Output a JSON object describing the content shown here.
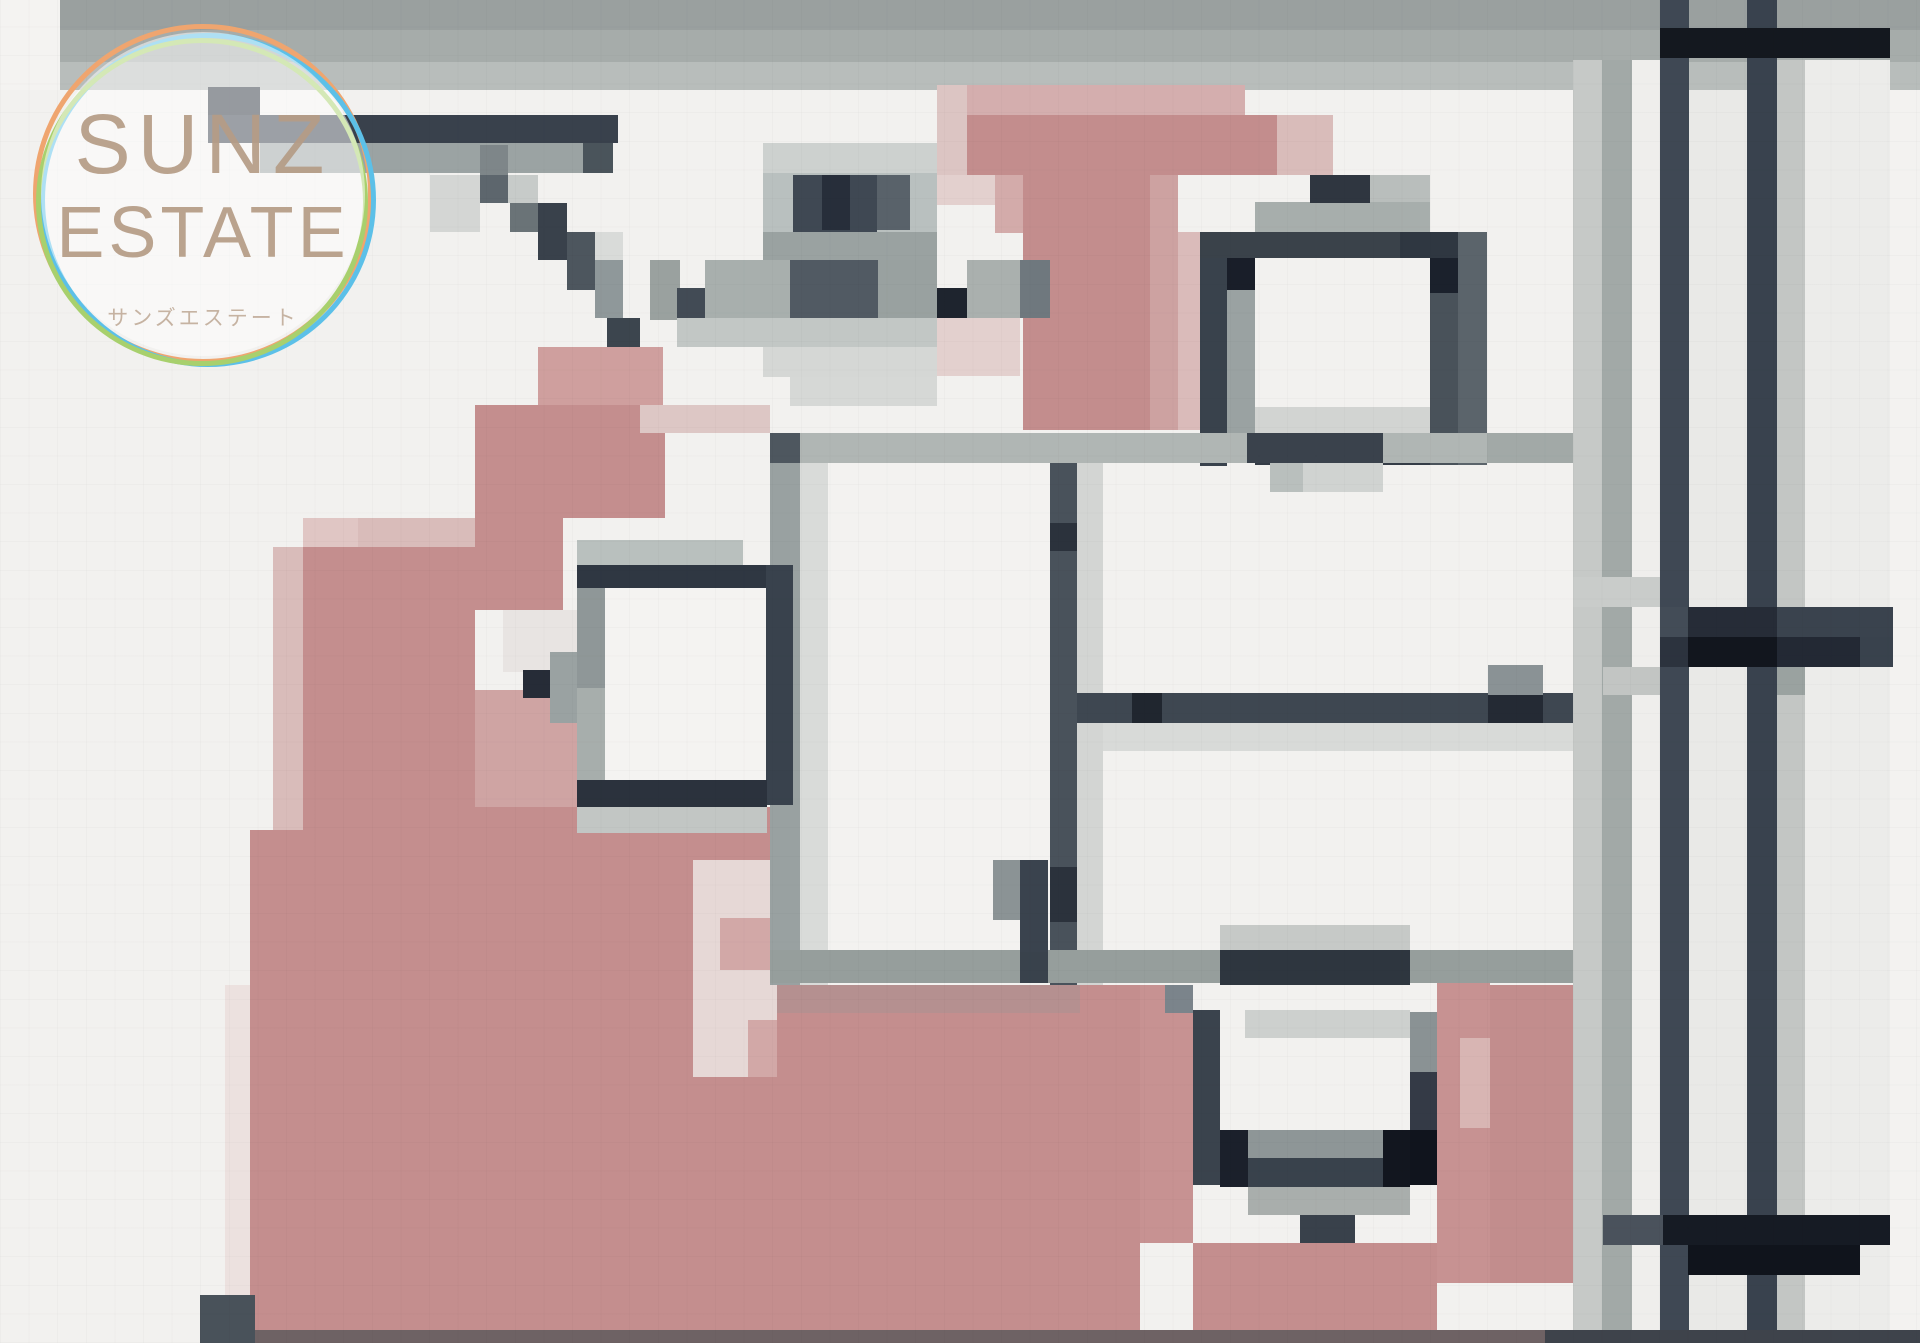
{
  "meta": {
    "description": "Pixelated (mosaic-censored) real-estate floor plan photo with agency watermark",
    "width": 1920,
    "height": 1343,
    "background": "#f2f1ef"
  },
  "logo": {
    "line1": "SUNZ",
    "line2": "ESTATE",
    "line3": "サンズエステート",
    "text_color": "#b59c86",
    "ring_colors": [
      "#efa56f",
      "#5cc0e8",
      "#a8d06d"
    ],
    "fill": "rgba(255,255,255,0.5)"
  },
  "palette_notes": {
    "wall_dark": "#39424c",
    "wall_black": "#12161e",
    "floor_pink": "#c48e8e",
    "floor_pink_light": "#d9bcba",
    "gray_wall": "#9ba3a3",
    "top_band": "#a6acaa",
    "background": "#f2f1ef"
  },
  "blocks": [
    [
      "#9aa09f",
      0,
      0,
      1920,
      30
    ],
    [
      "#a6acaa",
      0,
      30,
      1920,
      32
    ],
    [
      "#b8bdbb",
      0,
      62,
      1920,
      28
    ],
    [
      "#f4f3f1",
      0,
      0,
      60,
      90
    ],
    [
      "#c6c9c7",
      1573,
      60,
      29,
      1283
    ],
    [
      "#a2a9a7",
      1602,
      60,
      30,
      1283
    ],
    [
      "#efeeec",
      1632,
      60,
      28,
      1283
    ],
    [
      "#e9e9e7",
      1689,
      90,
      58,
      1253
    ],
    [
      "#c3c6c4",
      1777,
      60,
      28,
      1283
    ],
    [
      "#ececea",
      1805,
      60,
      85,
      1283
    ],
    [
      "#f3f2f0",
      1890,
      90,
      30,
      1253
    ],
    [
      "#3f4854",
      1660,
      0,
      29,
      1343
    ],
    [
      "#39424e",
      1747,
      0,
      30,
      1343
    ],
    [
      "#14181f",
      1660,
      28,
      230,
      30
    ],
    [
      "#2d343f",
      208,
      87,
      52,
      28
    ],
    [
      "#39414c",
      208,
      115,
      410,
      28
    ],
    [
      "#9ba3a3",
      260,
      143,
      323,
      30
    ],
    [
      "#4a545b",
      583,
      143,
      30,
      30
    ],
    [
      "#d4d6d4",
      430,
      175,
      50,
      57
    ],
    [
      "#7e8689",
      480,
      145,
      28,
      30
    ],
    [
      "#5d666d",
      480,
      175,
      30,
      28
    ],
    [
      "#c7cbc9",
      508,
      175,
      30,
      28
    ],
    [
      "#6a7377",
      510,
      203,
      28,
      29
    ],
    [
      "#39414b",
      538,
      203,
      29,
      57
    ],
    [
      "#d9dbd9",
      595,
      232,
      28,
      28
    ],
    [
      "#4d565e",
      567,
      232,
      28,
      58
    ],
    [
      "#8f989a",
      595,
      260,
      28,
      58
    ],
    [
      "#3c454e",
      607,
      318,
      33,
      29
    ],
    [
      "#cf9f9e",
      538,
      347,
      125,
      58
    ],
    [
      "#c48e8e",
      475,
      405,
      190,
      113
    ],
    [
      "#ddc7c5",
      640,
      405,
      130,
      28
    ],
    [
      "#e0c6c4",
      303,
      518,
      57,
      29
    ],
    [
      "#d9bcba",
      358,
      518,
      117,
      29
    ],
    [
      "#c48e8e",
      475,
      518,
      88,
      92
    ],
    [
      "#e8e4e2",
      503,
      610,
      74,
      62
    ],
    [
      "#cfa4a3",
      475,
      690,
      102,
      117
    ],
    [
      "#d9bcba",
      273,
      547,
      30,
      283
    ],
    [
      "#c48e8e",
      303,
      547,
      172,
      438
    ],
    [
      "#c48e8e",
      250,
      830,
      225,
      155
    ],
    [
      "#c48e8e",
      475,
      807,
      295,
      178
    ],
    [
      "#dcc5c3",
      937,
      85,
      30,
      90
    ],
    [
      "#d4aeae",
      967,
      85,
      278,
      30
    ],
    [
      "#c38d8d",
      967,
      115,
      310,
      60
    ],
    [
      "#d9bcba",
      1277,
      115,
      56,
      60
    ],
    [
      "#e3d0ce",
      937,
      175,
      58,
      30
    ],
    [
      "#d3abaa",
      995,
      175,
      30,
      58
    ],
    [
      "#c38d8d",
      1023,
      175,
      127,
      255
    ],
    [
      "#cda2a1",
      1150,
      175,
      28,
      255
    ],
    [
      "#dabbba",
      1178,
      232,
      32,
      198
    ],
    [
      "#e3d0ce",
      937,
      318,
      83,
      58
    ],
    [
      "#ece1df",
      225,
      985,
      25,
      345
    ],
    [
      "#c48e8e",
      250,
      985,
      890,
      345
    ],
    [
      "#e6d8d6",
      693,
      860,
      84,
      217
    ],
    [
      "#d2a8a7",
      720,
      918,
      57,
      52
    ],
    [
      "#d2a8a7",
      748,
      1020,
      29,
      57
    ],
    [
      "#cdd1cf",
      763,
      143,
      174,
      30
    ],
    [
      "#b9c0bf",
      763,
      173,
      174,
      59
    ],
    [
      "#3f4853",
      793,
      175,
      84,
      57
    ],
    [
      "#272e3a",
      822,
      175,
      28,
      55
    ],
    [
      "#59626a",
      877,
      175,
      33,
      55
    ],
    [
      "#9aa2a1",
      763,
      232,
      174,
      28
    ],
    [
      "#9aa19f",
      650,
      260,
      30,
      60
    ],
    [
      "#424b55",
      677,
      288,
      30,
      32
    ],
    [
      "#a8afad",
      705,
      260,
      85,
      60
    ],
    [
      "#515a63",
      790,
      260,
      88,
      58
    ],
    [
      "#99a1a0",
      878,
      260,
      59,
      58
    ],
    [
      "#1e242e",
      937,
      288,
      30,
      30
    ],
    [
      "#aab0ae",
      967,
      260,
      53,
      58
    ],
    [
      "#6f787e",
      1020,
      260,
      30,
      58
    ],
    [
      "#c2c7c5",
      677,
      318,
      260,
      29
    ],
    [
      "#d5d7d5",
      763,
      347,
      174,
      30
    ],
    [
      "#d6d8d6",
      790,
      377,
      147,
      29
    ],
    [
      "#a7aeac",
      1255,
      202,
      175,
      30
    ],
    [
      "#2f3640",
      1310,
      175,
      60,
      28
    ],
    [
      "#b9bebc",
      1370,
      175,
      60,
      27
    ],
    [
      "#3a424a",
      1200,
      232,
      200,
      26
    ],
    [
      "#2f3741",
      1400,
      232,
      87,
      26
    ],
    [
      "#39424c",
      1200,
      258,
      27,
      208
    ],
    [
      "#191e29",
      1227,
      258,
      28,
      32
    ],
    [
      "#9aa2a2",
      1227,
      290,
      28,
      145
    ],
    [
      "#f2f1ef",
      1255,
      290,
      175,
      117
    ],
    [
      "#d2d4d2",
      1255,
      407,
      175,
      28
    ],
    [
      "#1b212c",
      1430,
      258,
      28,
      35
    ],
    [
      "#49525a",
      1430,
      293,
      28,
      172
    ],
    [
      "#5b646b",
      1458,
      232,
      29,
      233
    ],
    [
      "#343c46",
      1255,
      435,
      175,
      30
    ],
    [
      "#b0b6b4",
      770,
      433,
      803,
      30
    ],
    [
      "#4e575f",
      770,
      433,
      30,
      30
    ],
    [
      "#3a424c",
      1247,
      433,
      136,
      30
    ],
    [
      "#a2a9a7",
      1487,
      433,
      86,
      30
    ],
    [
      "#b9bfbd",
      1270,
      463,
      33,
      29
    ],
    [
      "#d0d3d1",
      1303,
      463,
      80,
      29
    ],
    [
      "#99a1a1",
      770,
      463,
      30,
      522
    ],
    [
      "#d9dbd9",
      800,
      463,
      28,
      522
    ],
    [
      "#f3f2f0",
      828,
      463,
      222,
      522
    ],
    [
      "#b9c0be",
      577,
      540,
      166,
      25
    ],
    [
      "#2f3742",
      577,
      565,
      190,
      23
    ],
    [
      "#8f9798",
      577,
      588,
      28,
      100
    ],
    [
      "#a7aeac",
      577,
      688,
      28,
      92
    ],
    [
      "#f4f3f1",
      605,
      588,
      161,
      192
    ],
    [
      "#39424d",
      766,
      565,
      27,
      240
    ],
    [
      "#2b323d",
      577,
      780,
      190,
      27
    ],
    [
      "#c2c6c4",
      577,
      807,
      190,
      26
    ],
    [
      "#262c37",
      523,
      670,
      28,
      28
    ],
    [
      "#9aa2a2",
      550,
      652,
      27,
      71
    ],
    [
      "#49525b",
      1050,
      463,
      27,
      522
    ],
    [
      "#2b323c",
      1050,
      523,
      27,
      28
    ],
    [
      "#2b323c",
      1050,
      867,
      27,
      55
    ],
    [
      "#d3d5d3",
      1077,
      463,
      26,
      522
    ],
    [
      "#3e4751",
      1077,
      693,
      496,
      30
    ],
    [
      "#20262f",
      1132,
      693,
      30,
      30
    ],
    [
      "#d8dad8",
      1103,
      723,
      470,
      28
    ],
    [
      "#8a9295",
      1488,
      665,
      55,
      30
    ],
    [
      "#242a34",
      1488,
      695,
      55,
      28
    ],
    [
      "#969e9c",
      770,
      950,
      803,
      33
    ],
    [
      "#39424c",
      1020,
      950,
      28,
      33
    ],
    [
      "#b59090",
      777,
      985,
      303,
      28
    ],
    [
      "#8b9395",
      993,
      860,
      27,
      60
    ],
    [
      "#3a434e",
      1020,
      860,
      28,
      92
    ],
    [
      "#c6c9c7",
      1220,
      925,
      190,
      28
    ],
    [
      "#c79292",
      1140,
      985,
      53,
      258
    ],
    [
      "#c79292",
      1437,
      983,
      53,
      300
    ],
    [
      "#c28d8d",
      1490,
      985,
      53,
      298
    ],
    [
      "#d8b5b3",
      1460,
      1038,
      30,
      90
    ],
    [
      "#c28d8d",
      1543,
      985,
      30,
      298
    ],
    [
      "#2e363f",
      1220,
      950,
      190,
      35
    ],
    [
      "#7b848b",
      1165,
      985,
      28,
      28
    ],
    [
      "#c79292",
      1165,
      1013,
      28,
      200
    ],
    [
      "#3a434d",
      1193,
      1010,
      27,
      175
    ],
    [
      "#cdd0ce",
      1245,
      1010,
      165,
      28
    ],
    [
      "#f2f1ef",
      1245,
      1038,
      165,
      92
    ],
    [
      "#8a9294",
      1410,
      1012,
      27,
      60
    ],
    [
      "#343a46",
      1410,
      1072,
      27,
      58
    ],
    [
      "#10141d",
      1410,
      1130,
      27,
      55
    ],
    [
      "#1b202b",
      1220,
      1130,
      28,
      57
    ],
    [
      "#8e9697",
      1248,
      1130,
      162,
      28
    ],
    [
      "#39424c",
      1248,
      1158,
      135,
      29
    ],
    [
      "#12161f",
      1383,
      1130,
      27,
      57
    ],
    [
      "#a9aeac",
      1248,
      1187,
      162,
      28
    ],
    [
      "#39414b",
      1300,
      1215,
      55,
      28
    ],
    [
      "#c48e8e",
      1193,
      1243,
      244,
      87
    ],
    [
      "#c9ccca",
      1573,
      577,
      87,
      30
    ],
    [
      "#434c57",
      1660,
      607,
      28,
      30
    ],
    [
      "#262c37",
      1688,
      607,
      89,
      30
    ],
    [
      "#3a434e",
      1777,
      607,
      116,
      30
    ],
    [
      "#2c333e",
      1660,
      637,
      28,
      30
    ],
    [
      "#12161e",
      1688,
      637,
      89,
      30
    ],
    [
      "#232934",
      1777,
      637,
      83,
      30
    ],
    [
      "#39424d",
      1860,
      637,
      33,
      30
    ],
    [
      "#c2c5c3",
      1603,
      667,
      57,
      28
    ],
    [
      "#9aa2a0",
      1777,
      667,
      28,
      28
    ],
    [
      "#4a525c",
      1603,
      1215,
      60,
      30
    ],
    [
      "#161b24",
      1663,
      1215,
      227,
      30
    ],
    [
      "#10141c",
      1688,
      1245,
      172,
      30
    ],
    [
      "#49525a",
      200,
      1295,
      55,
      48
    ],
    [
      "#6e6264",
      255,
      1330,
      1290,
      13
    ],
    [
      "#3e434b",
      1545,
      1330,
      375,
      13
    ]
  ]
}
